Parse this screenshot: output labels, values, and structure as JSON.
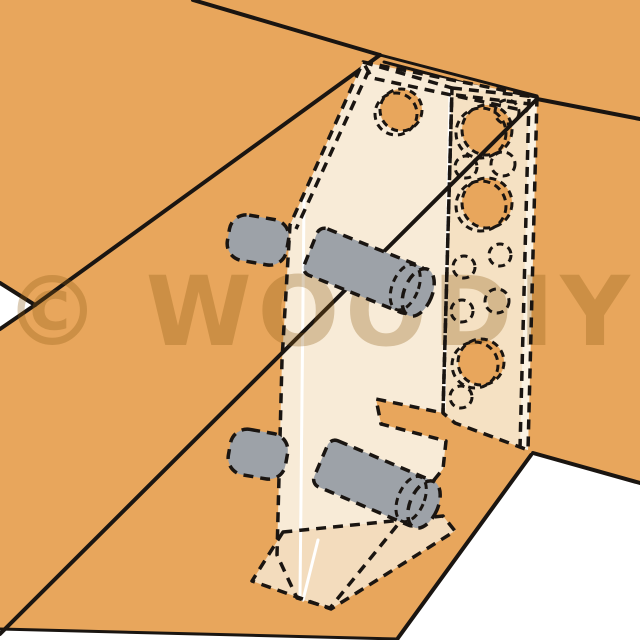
{
  "watermark": {
    "text": "© WOODIY"
  },
  "colors": {
    "background-white": "#ffffff",
    "board-orange": "#e8a65c",
    "line-black": "#1a1511",
    "bracket-web-cream": "#f8ebd7",
    "bracket-plate-cream": "#f5e1c3",
    "bracket-top-band": "#f6e6ce",
    "bracket-edge-strip": "#fbf2e2",
    "bracket-base-flange": "#f3dcbd",
    "dowel-gray": "#9da2a8",
    "crease-white": "#ffffff",
    "watermark-tint": "rgba(138,90,16,0.30)"
  },
  "scene": {
    "upper_board": "upper wooden board",
    "right_board": "right wooden post",
    "bottom_board": "bottom wooden board",
    "bracket": "phantom angle bracket with drill holes",
    "dowels": "gray wooden dowels"
  }
}
